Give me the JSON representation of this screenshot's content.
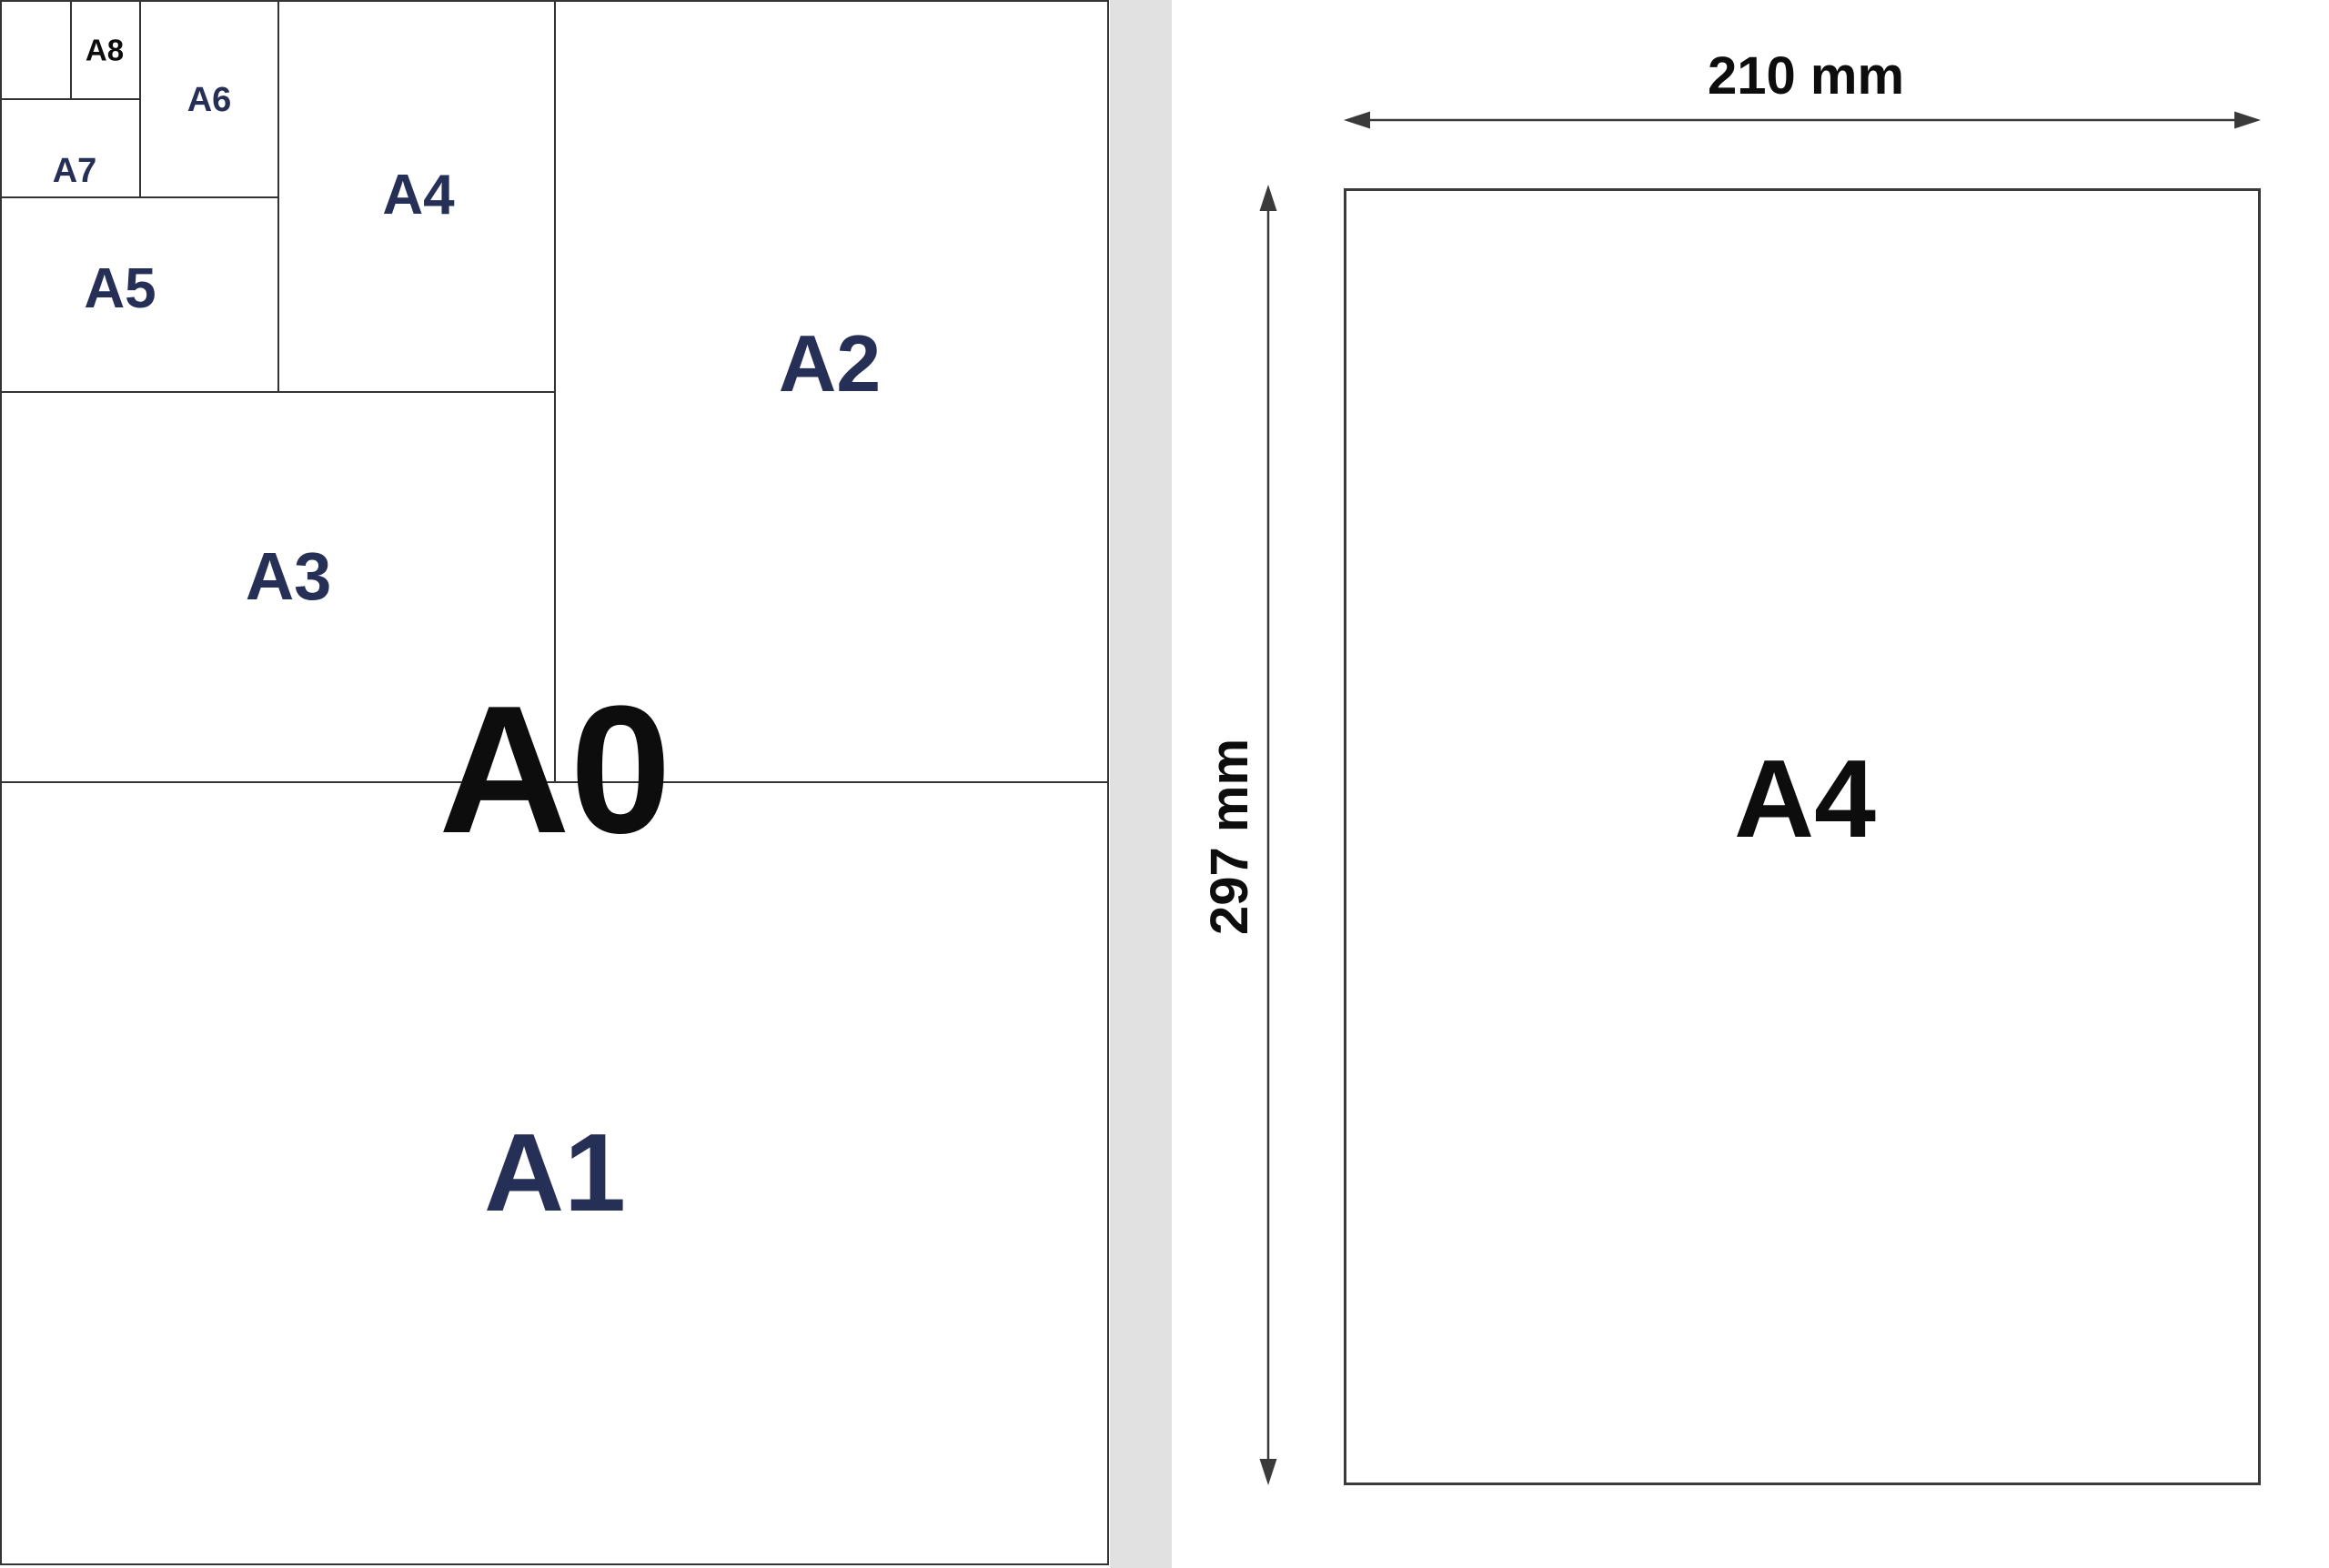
{
  "left_diagram": {
    "sheet_label": "A0",
    "labels": {
      "a1": "A1",
      "a2": "A2",
      "a3": "A3",
      "a4": "A4",
      "a5": "A5",
      "a6": "A6",
      "a7": "A7",
      "a8": "A8"
    },
    "navy_label_color": "#262f55",
    "black_label_color": "#0d0d0d",
    "line_color": "#333333"
  },
  "right_panel": {
    "page_label": "A4",
    "width_dimension_label": "210 mm",
    "height_dimension_label": "297 mm",
    "page_border_color": "#3a3a3a",
    "arrow_color": "#3a3a3a",
    "text_color": "#0d0d0d"
  },
  "divider": {
    "color": "#e1e1e1"
  },
  "background_color": "#ffffff"
}
